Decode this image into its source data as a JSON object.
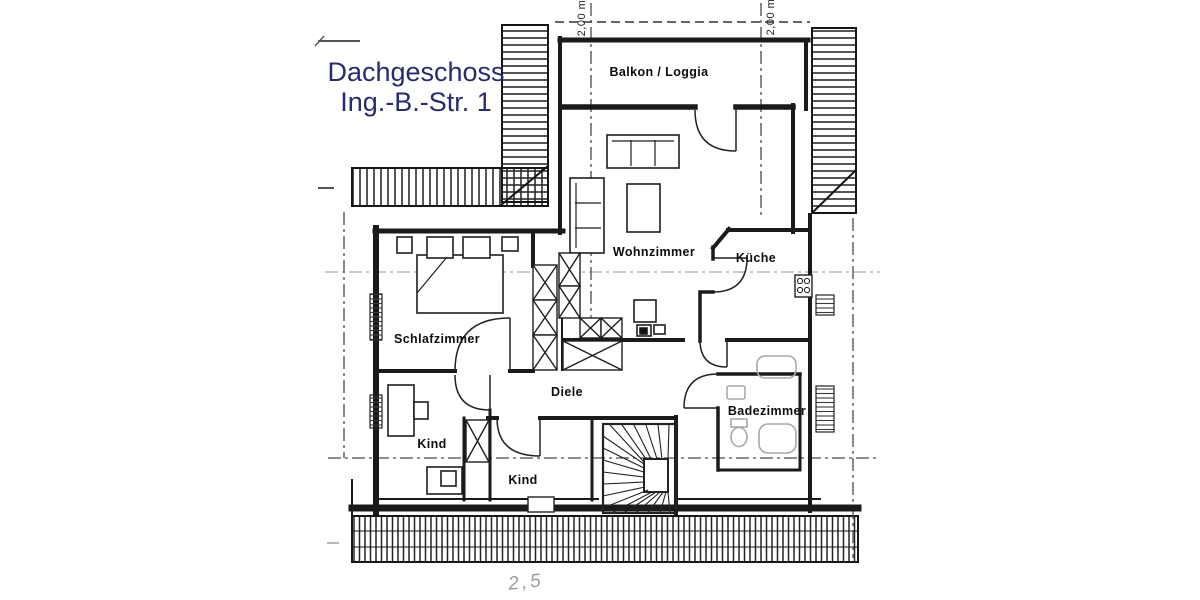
{
  "title": {
    "line1": "Dachgeschoss",
    "line2": "Ing.-B.-Str. 1"
  },
  "rooms": {
    "balkon": "Balkon / Loggia",
    "wohnzimmer": "Wohnzimmer",
    "kueche": "Küche",
    "schlafzimmer": "Schlafzimmer",
    "diele": "Diele",
    "badezimmer": "Badezimmer",
    "kind1": "Kind",
    "kind2": "Kind"
  },
  "dimensions": {
    "top_left": "2,00 m",
    "top_right": "2,00 m",
    "handwritten_note": "2,5"
  },
  "colors": {
    "title_text": "#282c6e",
    "wall": "#1a1a1a",
    "fixture_gray": "#a9a9a9",
    "paper": "#ffffff"
  }
}
